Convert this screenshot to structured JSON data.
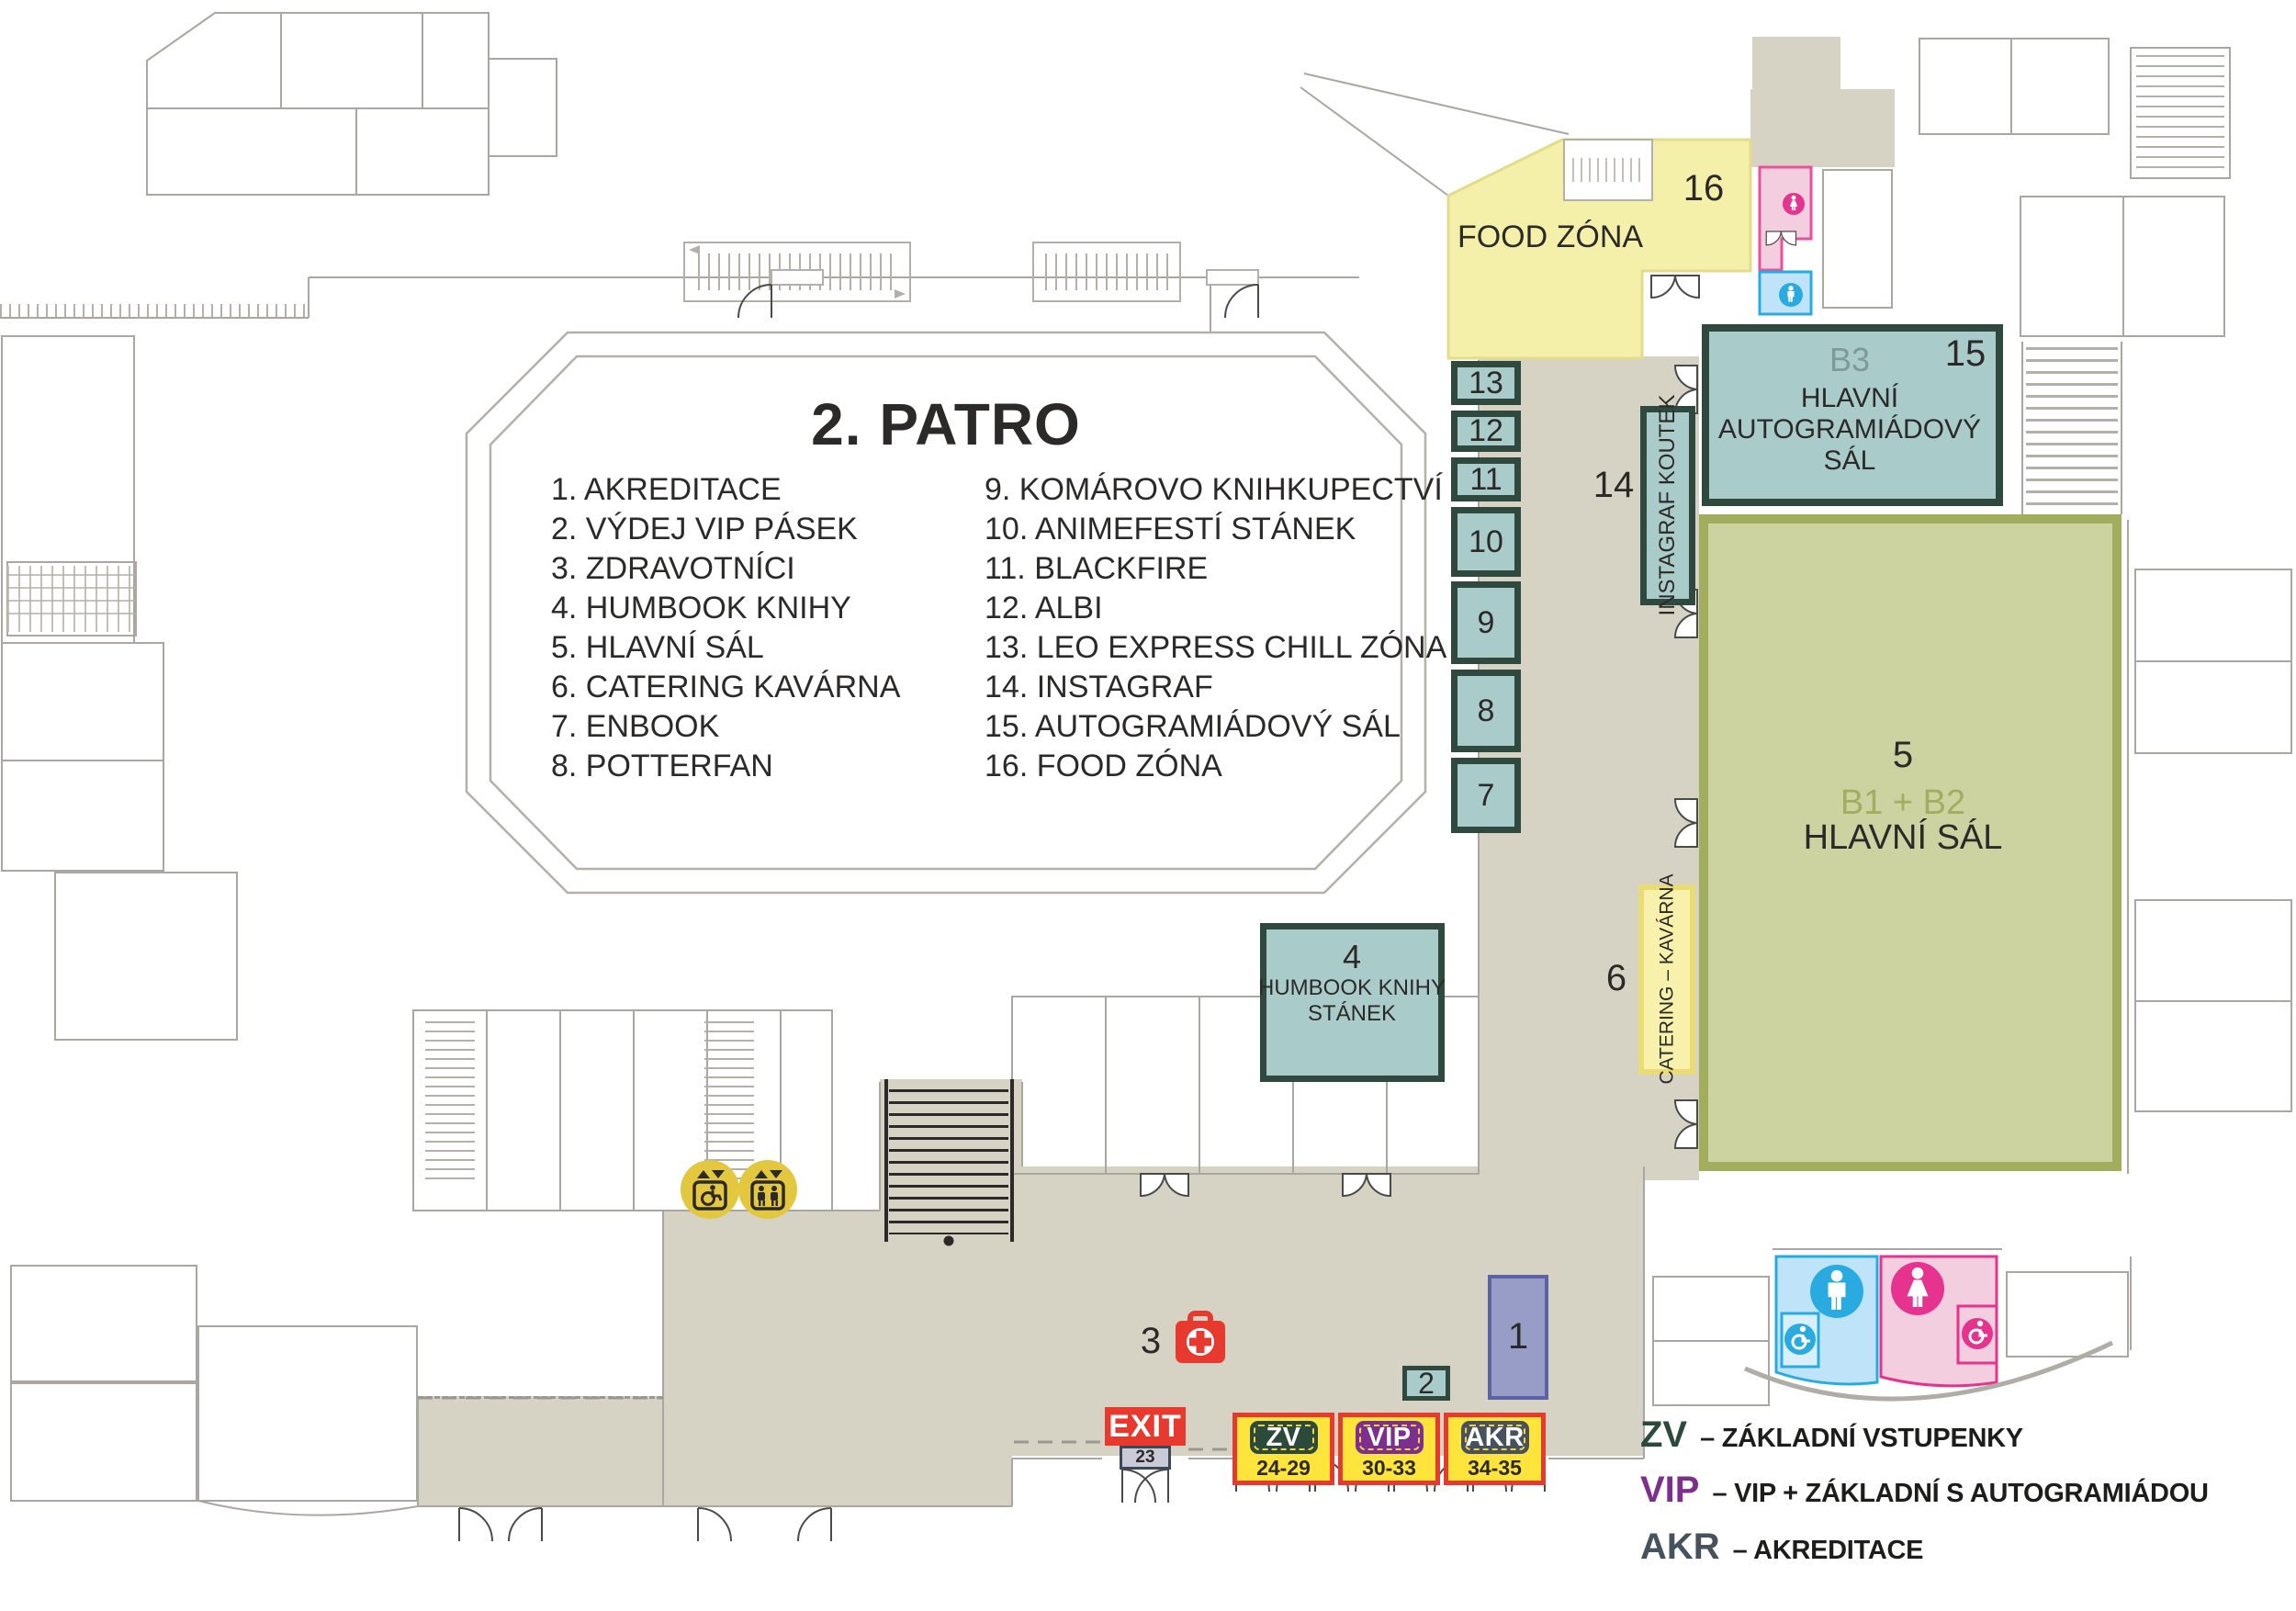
{
  "floor": {
    "title": "2. PATRO"
  },
  "legend": {
    "items_left": [
      "1. AKREDITACE",
      "2. VÝDEJ VIP PÁSEK",
      "3. ZDRAVOTNÍCI",
      "4. HUMBOOK KNIHY",
      "5. HLAVNÍ SÁL",
      "6. CATERING KAVÁRNA",
      "7. ENBOOK",
      "8. POTTERFAN"
    ],
    "items_right": [
      "9. KOMÁROVO KNIHKUPECTVÍ",
      "10. ANIMEFESTÍ STÁNEK",
      "11. BLACKFIRE",
      "12. ALBI",
      "13. LEO EXPRESS CHILL ZÓNA",
      "14. INSTAGRAF",
      "15. AUTOGRAMIÁDOVÝ SÁL",
      "16. FOOD ZÓNA"
    ]
  },
  "zones": {
    "food": {
      "number": "16",
      "label": "FOOD ZÓNA"
    },
    "b3": {
      "code": "B3",
      "number": "15",
      "line1": "HLAVNÍ",
      "line2": "AUTOGRAMIÁDOVÝ",
      "line3": "SÁL"
    },
    "main_hall": {
      "number": "5",
      "code": "B1 + B2",
      "name": "HLAVNÍ SÁL"
    },
    "humbook": {
      "number": "4",
      "line1": "HUMBOOK KNIHY",
      "line2": "STÁNEK"
    },
    "instagraf": {
      "number": "14",
      "label": "INSTAGRAF KOUTEK"
    },
    "catering": {
      "number": "6",
      "label": "CATERING – KAVÁRNA"
    },
    "stalls": [
      "13",
      "12",
      "11",
      "10",
      "9",
      "8",
      "7"
    ],
    "akreditace": {
      "number": "1"
    },
    "vydej_vip": {
      "number": "2"
    },
    "zdravotnici": {
      "number": "3"
    }
  },
  "exit": {
    "label": "EXIT",
    "door": "23"
  },
  "tickets": {
    "booths": [
      {
        "code": "ZV",
        "range": "24-29"
      },
      {
        "code": "VIP",
        "range": "30-33"
      },
      {
        "code": "AKR",
        "range": "34-35"
      }
    ],
    "legend": [
      {
        "code": "ZV",
        "desc": "– ZÁKLADNÍ VSTUPENKY"
      },
      {
        "code": "VIP",
        "desc": "– VIP + ZÁKLADNÍ S AUTOGRAMIÁDOU"
      },
      {
        "code": "AKR",
        "desc": "– AKREDITACE"
      }
    ]
  },
  "icons": {
    "woman": "woman-icon",
    "man": "man-icon",
    "wheelchair": "wheelchair-icon",
    "elevator_accessible": "accessible-elevator-icon",
    "elevator": "elevator-icon",
    "first_aid": "first-aid-icon",
    "exit": "exit-sign",
    "escalator": "escalator-icon"
  },
  "colors": {
    "beige": "#d6d3c5",
    "teal_fill": "#a9cbc9",
    "teal_border": "#30493f",
    "green_fill": "#cdd3a0",
    "green_border": "#a2ae5e",
    "yellow_zone": "#f4efa9",
    "ticket_yellow": "#ffe53b",
    "red": "#e8392f",
    "zv_green": "#2c4a3b",
    "vip_purple": "#7d2f8f",
    "akr_slate": "#47525f",
    "pink": "#e5338f",
    "blue": "#29abe2",
    "purple_room": "#989dc8",
    "elevator_yellow": "#e3c83f"
  }
}
